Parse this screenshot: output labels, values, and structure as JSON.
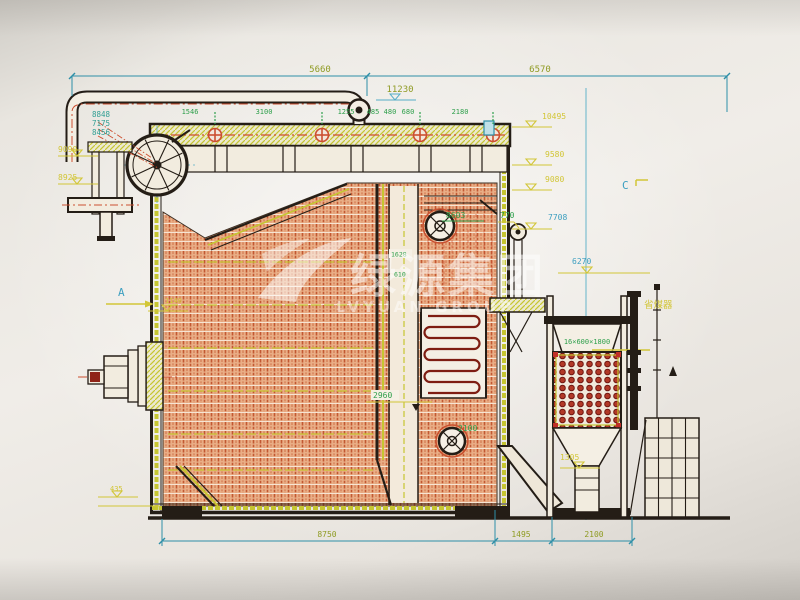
{
  "watermark": {
    "company_cn": "绿源集团",
    "company_en": "LVYUAN GROUP"
  },
  "dimensions": {
    "top": {
      "span_left": "5660",
      "span_right": "6570",
      "level": "11230",
      "row": [
        "1546",
        "3100",
        "1255",
        "485",
        "480",
        "680",
        "2180"
      ]
    },
    "left": {
      "stack": [
        "8848",
        "7175",
        "8456"
      ],
      "levels": [
        "9090",
        "8925"
      ],
      "section_a": "A",
      "width_1140": "1140",
      "level_435": "435"
    },
    "right": {
      "levels": [
        "10495",
        "9580",
        "9080"
      ],
      "level_7708": "7708",
      "level_6270": "6270",
      "section_c": "C",
      "econ_label": "16×600×1800",
      "econ_name": "省煤器",
      "level_1305": "1305"
    },
    "center": {
      "manhole_upper": "8603",
      "pipe": "770",
      "tube_1628": "1628",
      "tube_610": "610",
      "width_2960": "2960",
      "manhole_lower": "2100"
    },
    "bottom": {
      "spans": [
        "8750",
        "1495",
        "2100"
      ]
    }
  },
  "colors": {
    "paper": "#efece7",
    "dimension_teal": "#2e8fa8",
    "outline_dark": "#241d16",
    "wall_hatch_orange": "#c25832",
    "casing_yellow": "#c6c531",
    "dim_green": "#2fa04c",
    "dim_yellow": "#d2c637",
    "dim_olive": "#8f9b23",
    "dim_cyan": "#3d9fc0",
    "centerline_red": "#cc4f30",
    "watermark_white": "#ffffff"
  }
}
